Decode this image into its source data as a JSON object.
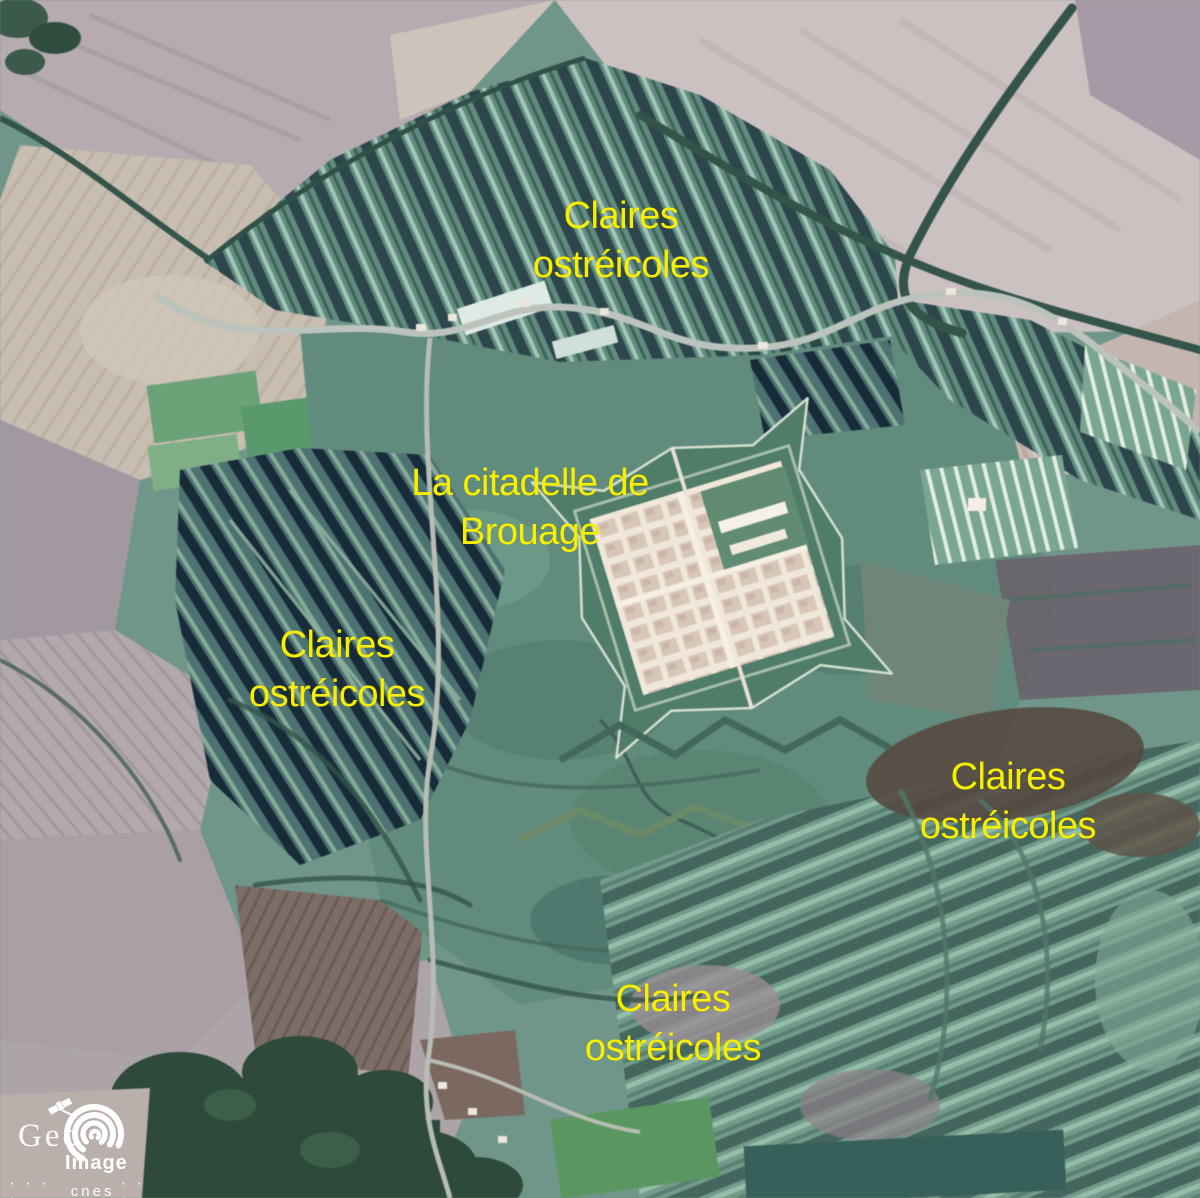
{
  "annotations": {
    "top": {
      "line1": "Claires",
      "line2": "ostréicoles"
    },
    "citadel": {
      "line1": "La citadelle de",
      "line2": "Brouage"
    },
    "left": {
      "line1": "Claires",
      "line2": "ostréicoles"
    },
    "right": {
      "line1": "Claires",
      "line2": "ostréicoles"
    },
    "bottom": {
      "line1": "Claires",
      "line2": "ostréicoles"
    }
  },
  "logo": {
    "geo": "Geo",
    "image": "Image",
    "cnes": "cnes",
    "dots_left": "· · · ·",
    "dots_right": "· · ·"
  },
  "colors": {
    "annotation_yellow": "#f7ef00",
    "logo_white": "#ffffff",
    "marsh_green": "#6f968a",
    "claire_dark_teal": "#2c464c",
    "field_beige": "#c7bdb0",
    "field_pale_pink": "#ccc1c1",
    "field_mauve": "#aca1a7",
    "plowed_brown": "#7e6d66",
    "forest_dark": "#2c4a3a",
    "citadel_cream": "#efe7d8"
  }
}
